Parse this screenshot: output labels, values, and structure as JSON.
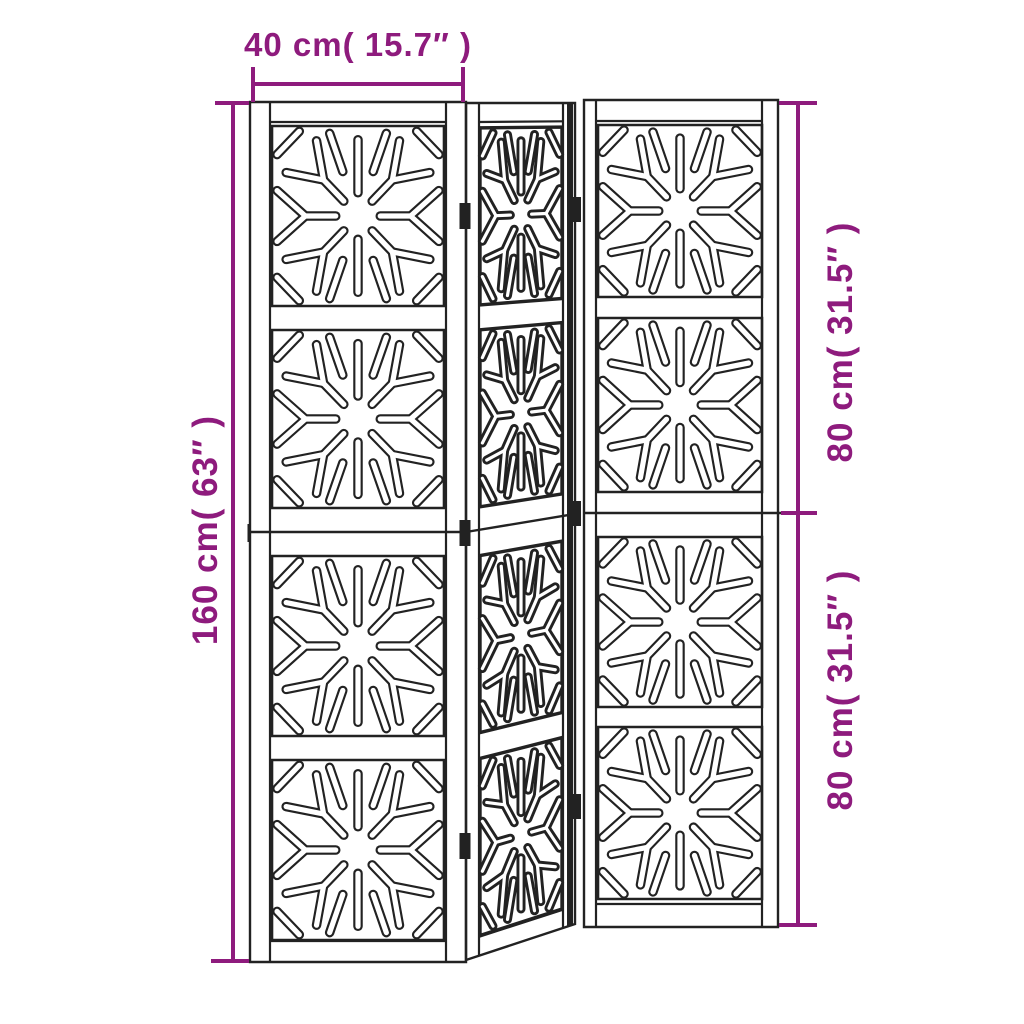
{
  "diagram": {
    "background_color": "#ffffff",
    "line_color": "#222222",
    "accent_color": "#8E1B7D",
    "dimensions": {
      "width_label": "40 cm( 15.7″ )",
      "height_label": "160 cm( 63″ )",
      "upper_half_label": "80 cm( 31.5″ )",
      "lower_half_label": "80 cm( 31.5″ )"
    },
    "panels": {
      "count": 3,
      "pattern_squares_per_panel": 4,
      "pattern_style": "sunburst cut-out"
    }
  }
}
